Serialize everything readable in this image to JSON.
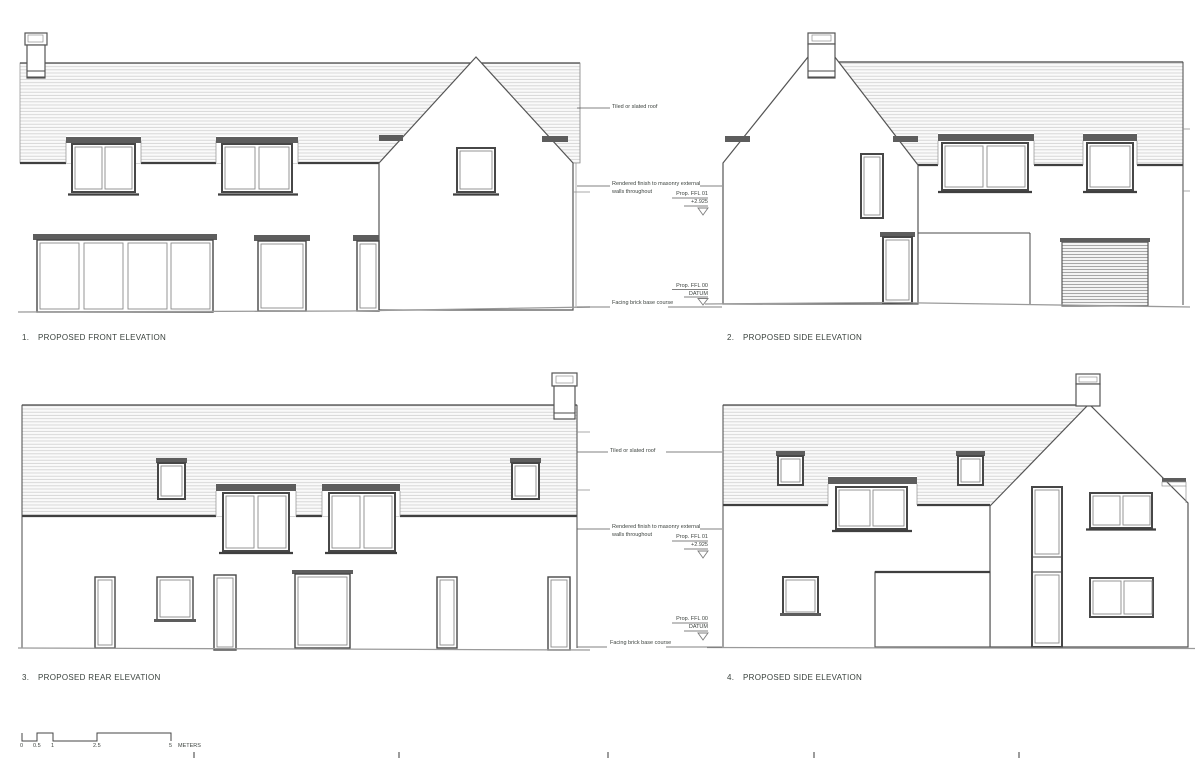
{
  "annotations": {
    "tiled_roof": "Tiled or slated roof",
    "rendered_finish_line1": "Rendered finish to masonry external",
    "rendered_finish_line2": "walls throughout",
    "ffl01_label": "Prop. FFL 01",
    "ffl01_value": "+2.925",
    "ffl00_label": "Prop. FFL 00",
    "ffl00_value": "DATUM",
    "facing_brick": "Facing brick base course"
  },
  "elevations": [
    {
      "number": "1.",
      "title": "PROPOSED FRONT ELEVATION"
    },
    {
      "number": "2.",
      "title": "PROPOSED SIDE ELEVATION"
    },
    {
      "number": "3.",
      "title": "PROPOSED REAR ELEVATION"
    },
    {
      "number": "4.",
      "title": "PROPOSED SIDE ELEVATION"
    }
  ],
  "scale_bar": {
    "marks": [
      "0",
      "0.5",
      "1",
      "2.5",
      "5"
    ],
    "unit": "METERS"
  },
  "colors": {
    "line": "#4a4a4a",
    "hatch": "#cfcfcf",
    "band": "#5d5d5d",
    "background": "#ffffff"
  }
}
